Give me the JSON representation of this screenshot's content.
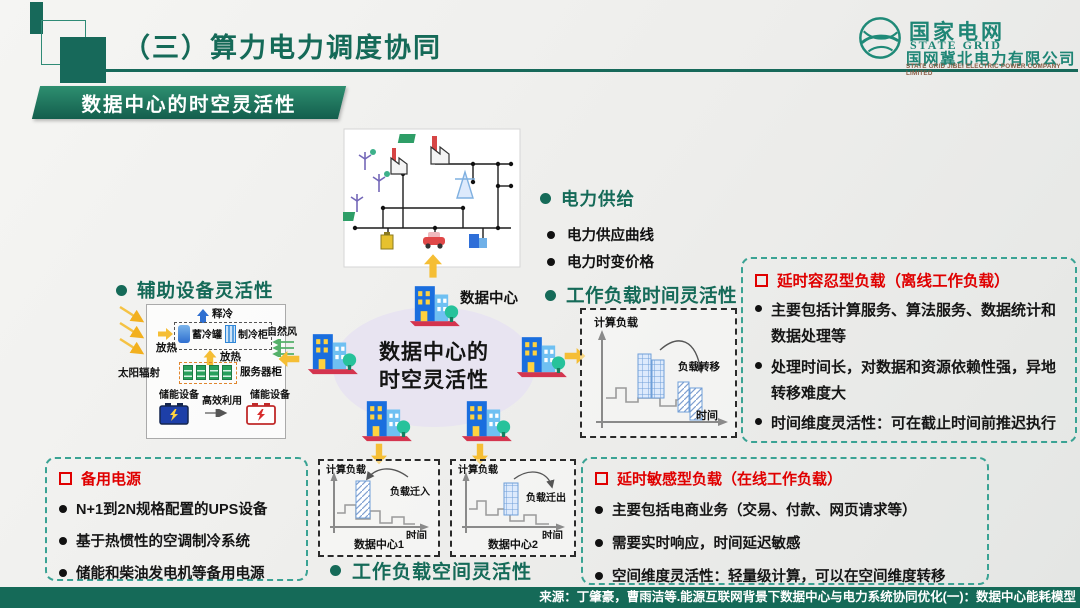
{
  "header": {
    "title": "（三）算力电力调度协同"
  },
  "logo": {
    "brand_cn": "国家电网",
    "brand_en": "STATE GRID",
    "company_cn": "国网冀北电力有限公司",
    "company_en": "STATE GRID JIBEI ELECTRIC POWER COMPANY LIMITED"
  },
  "banner": {
    "label": "数据中心的时空灵活性"
  },
  "power_supply": {
    "heading": "电力供给",
    "items": [
      "电力供应曲线",
      "电力时变价格"
    ]
  },
  "aux": {
    "heading": "辅助设备灵活性",
    "release_cold": "释冷",
    "cold_tank": "蓄冷罐",
    "cold_cabinet": "制冷柜",
    "natural_wind": "自然风",
    "heat_release_left": "放热",
    "heat_release_mid": "放热",
    "solar_radiation": "太阳辐射",
    "server_cabinet": "服务器柜",
    "storage_left": "储能设备",
    "storage_right": "储能设备",
    "efficient_use": "高效利用"
  },
  "center": {
    "ellipse_line1": "数据中心的",
    "ellipse_line2": "时空灵活性",
    "datacenter_label": "数据中心"
  },
  "time_flex": {
    "heading": "工作负载时间灵活性",
    "ylabel": "计算负载",
    "xlabel": "时间",
    "note": "负载转移"
  },
  "space_flex": {
    "heading": "工作负载空间灵活性",
    "charts": [
      {
        "ylabel": "计算负载",
        "xlabel": "时间",
        "name": "数据中心1",
        "note": "负载迁入"
      },
      {
        "ylabel": "计算负载",
        "xlabel": "时间",
        "name": "数据中心2",
        "note": "负载迁出"
      }
    ]
  },
  "delay_tolerant": {
    "title": "延时容忍型负载（离线工作负载）",
    "items": [
      "主要包括计算服务、算法服务、数据统计和数据处理等",
      "处理时间长，对数据和资源依赖性强，异地转移难度大",
      "时间维度灵活性：可在截止时间前推迟执行"
    ]
  },
  "delay_sensitive": {
    "title": "延时敏感型负载（在线工作负载）",
    "items": [
      "主要包括电商业务（交易、付款、网页请求等）",
      "需要实时响应，时间延迟敏感",
      "空间维度灵活性：轻量级计算，可以在空间维度转移"
    ]
  },
  "backup_power": {
    "title": "备用电源",
    "items": [
      "N+1到2N规格配置的UPS设备",
      "基于热惯性的空调制冷系统",
      "储能和柴油发电机等备用电源"
    ]
  },
  "footer": {
    "source": "来源：丁肇豪，曹雨洁等.能源互联网背景下数据中心与电力系统协同优化(一)：数据中心能耗模型"
  },
  "colors": {
    "accent_green": "#156A58",
    "box_border_teal": "#3AA394",
    "alert_red": "#E00000",
    "arrow_yellow": "#F5BE35",
    "ellipse_lavender": "#E8E4F1"
  }
}
